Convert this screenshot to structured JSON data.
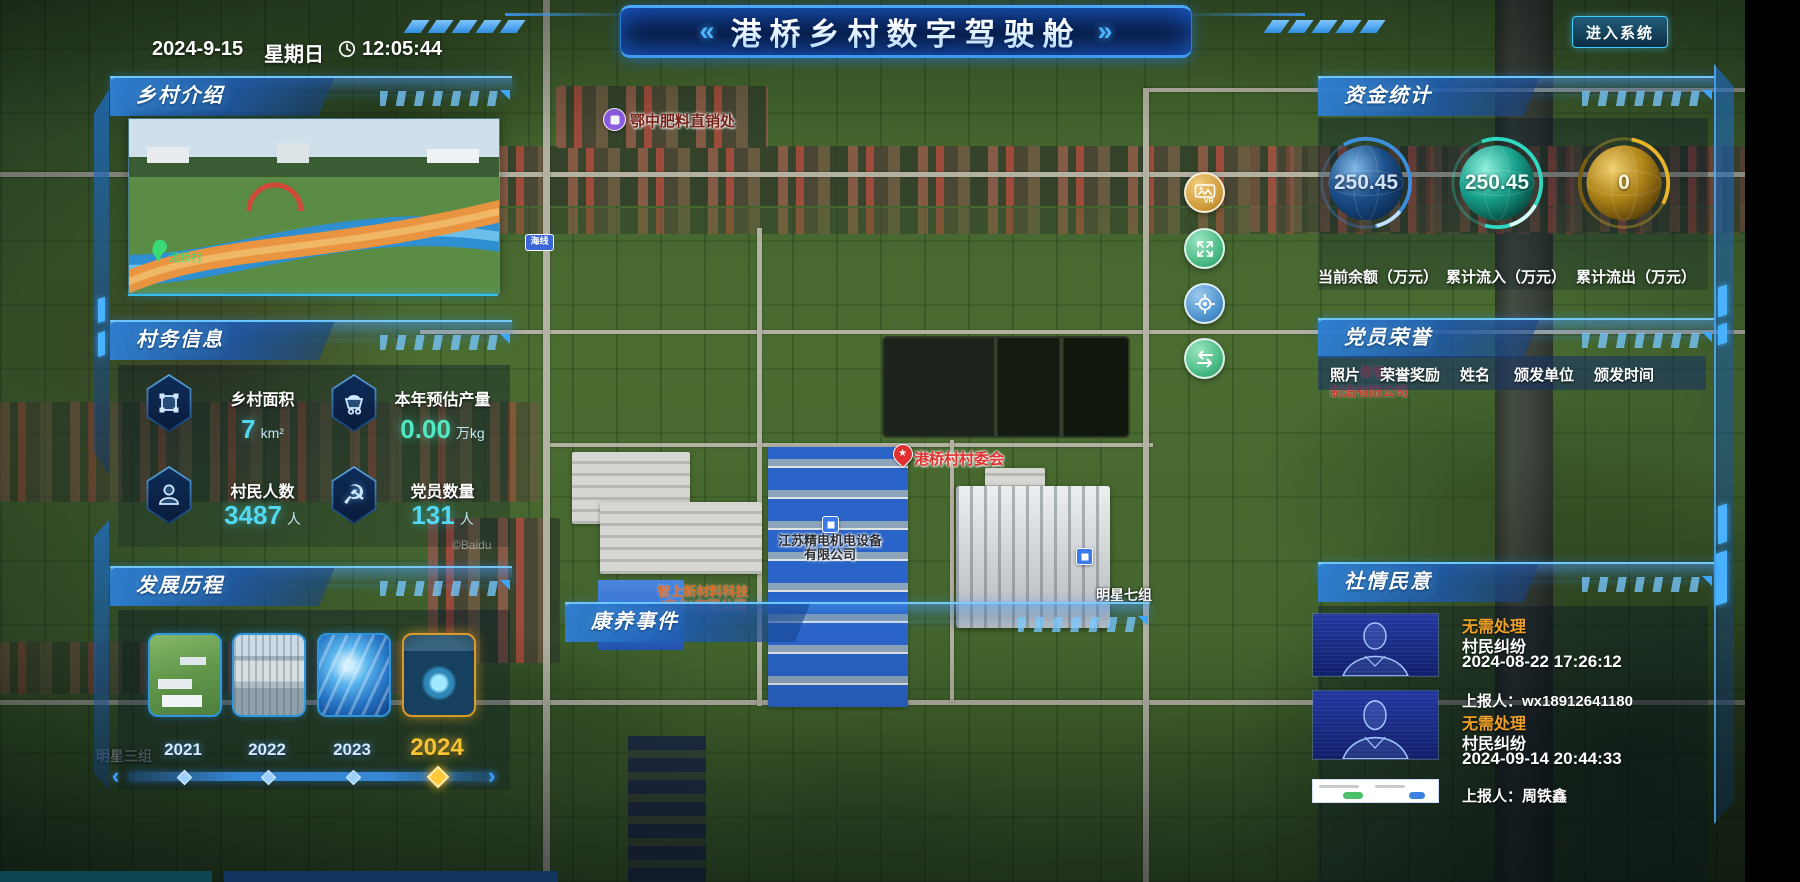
{
  "colors": {
    "panel_blue": "#2e7fd4",
    "accent_cyan": "#49d6ff",
    "value_cyan": "#52d8f0",
    "value_green": "#52e8c2",
    "status_orange": "#f0a028",
    "gauge_blue": "#3e8ede",
    "gauge_teal": "#2fd8c0",
    "gauge_gold": "#e0b02a",
    "year_active_gold": "#f5c433",
    "map_label_red": "#e23030",
    "map_label_orange": "#d86a28"
  },
  "topbar": {
    "date": "2024-9-15",
    "weekday": "星期日",
    "time": "12:05:44",
    "chevron_left": "«",
    "chevron_right": "»",
    "title": "港桥乡村数字驾驶舱",
    "enter_button": "进入系统"
  },
  "village_intro": {
    "title": "乡村介绍",
    "photo_location": "港桥村"
  },
  "village_affairs": {
    "title": "村务信息",
    "stats": [
      {
        "label": "乡村面积",
        "value": "7",
        "unit": "km²"
      },
      {
        "label": "本年预估产量",
        "value": "0.00",
        "unit": "万kg"
      },
      {
        "label": "村民人数",
        "value": "3487",
        "unit": "人"
      },
      {
        "label": "党员数量",
        "value": "131",
        "unit": "人"
      }
    ],
    "party_icon_glyph": "☭"
  },
  "development": {
    "title": "发展历程",
    "years": [
      "2021",
      "2022",
      "2023",
      "2024"
    ],
    "active_year": "2024",
    "prev_arrow": "‹",
    "next_arrow": "›"
  },
  "funds": {
    "title": "资金统计",
    "gauges": [
      {
        "value": "250.45",
        "label": "当前余额（万元）",
        "color": "#3e8ede"
      },
      {
        "value": "250.45",
        "label": "累计流入（万元）",
        "color": "#2fd8c0"
      },
      {
        "value": "0",
        "label": "累计流出（万元）",
        "color": "#e0b02a"
      }
    ]
  },
  "party_honor": {
    "title": "党员荣誉",
    "columns": [
      "照片",
      "荣誉奖励",
      "姓名",
      "颁发单位",
      "颁发时间"
    ]
  },
  "public_opinion": {
    "title": "社情民意",
    "items": [
      {
        "status": "无需处理",
        "category": "村民纠纷",
        "time": "2024-08-22 17:26:12",
        "reporter": "上报人：wx18912641180"
      },
      {
        "status": "无需处理",
        "category": "村民纠纷",
        "time": "2024-09-14 20:44:33",
        "reporter": "上报人：周铁鑫"
      }
    ]
  },
  "health_events": {
    "title": "康养事件"
  },
  "map": {
    "labels": {
      "fertilizer": "鄂中肥料直销处",
      "committee": "港桥村村委会",
      "committee_star": "★",
      "company1_line1": "江苏精电机电设备",
      "company1_line2": "有限公司",
      "company2_line1": "智上新材料科技",
      "company2_line2": "(东台)有限公司",
      "group7": "明星七组",
      "group3": "明星三组",
      "behind_honor_line1": "春智",
      "behind_honor_line2": "制造有限公司",
      "road_badge": "海线",
      "copyright": "©Baidu"
    },
    "buttons": {
      "vr": "VR"
    }
  }
}
